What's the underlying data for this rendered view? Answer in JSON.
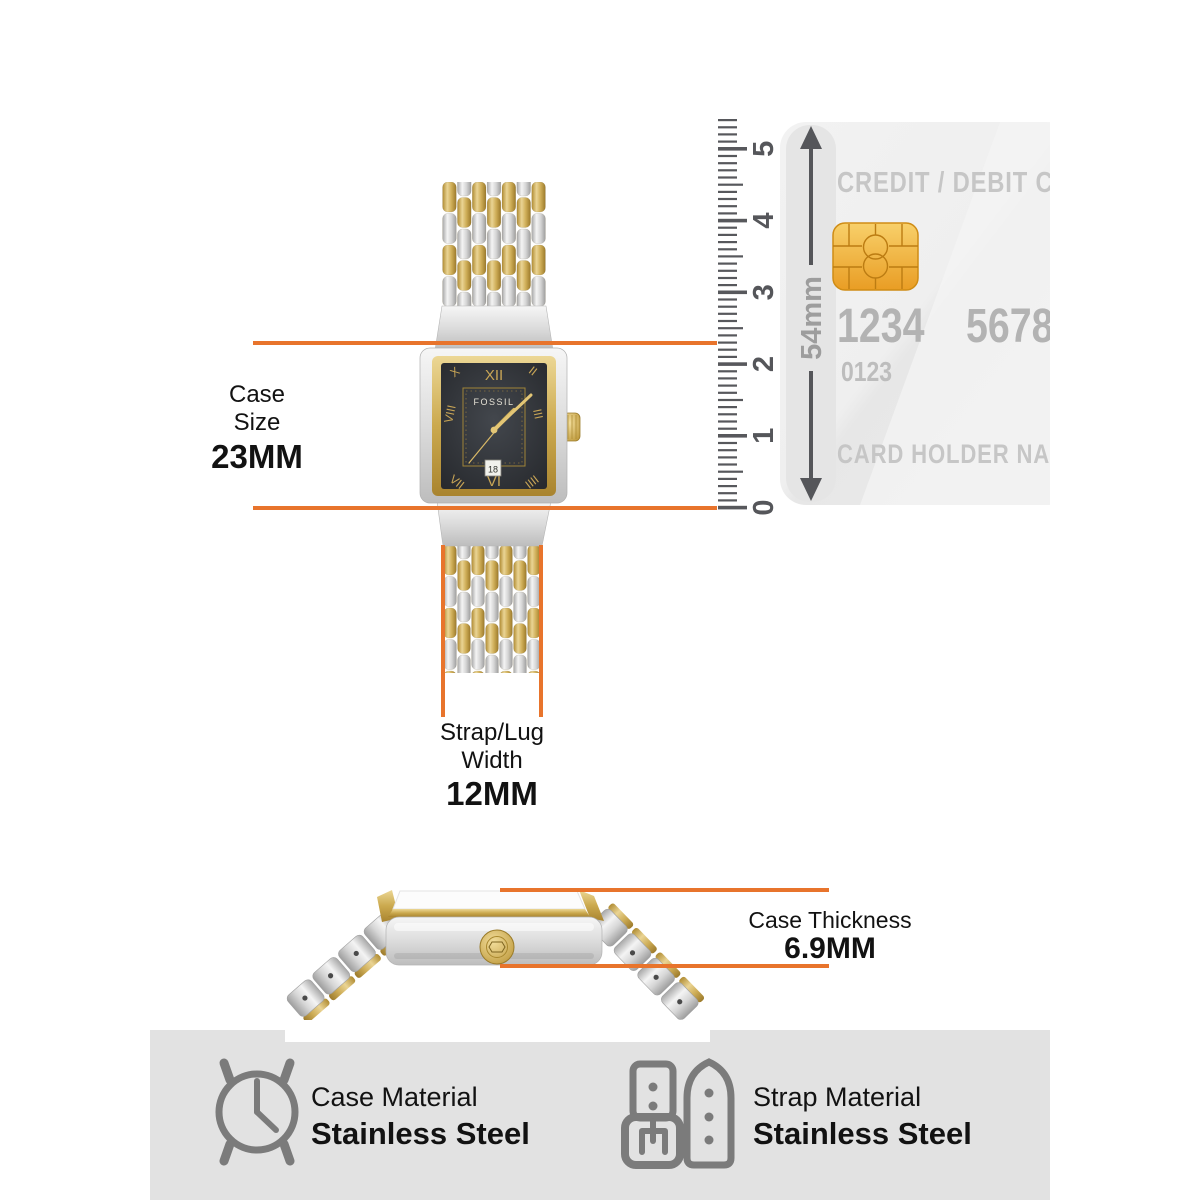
{
  "annotations": {
    "case_size": {
      "label_line1": "Case",
      "label_line2": "Size",
      "value": "23MM"
    },
    "strap_width": {
      "label_line1": "Strap/Lug",
      "label_line2": "Width",
      "value": "12MM"
    },
    "case_thickness": {
      "label": "Case Thickness",
      "value": "6.9MM"
    }
  },
  "ruler": {
    "unit_labels": [
      "0",
      "1",
      "2",
      "3",
      "4",
      "5"
    ],
    "height_label": "54mm"
  },
  "card": {
    "title": "CREDIT / DEBIT CARD",
    "number_left": "1234",
    "number_right": "5678",
    "number_small": "0123",
    "holder": "CARD HOLDER NAME"
  },
  "watch": {
    "brand": "FOSSIL",
    "date": "18",
    "numerals": {
      "top": "XII",
      "bottom": "VI",
      "upper_left": "X",
      "left": "VIII",
      "lower_left": "VII",
      "upper_right": "II",
      "right": "III",
      "lower_right": "IIII"
    }
  },
  "footer": {
    "case_material": {
      "label": "Case Material",
      "value": "Stainless Steel"
    },
    "strap_material": {
      "label": "Strap Material",
      "value": "Stainless Steel"
    }
  },
  "colors": {
    "accent_orange": "#E8742C",
    "gold": "#CFAE58",
    "gold_light": "#EAD494",
    "gold_dark": "#A9842F",
    "silver": "#D9D9D9",
    "silver_light": "#F4F4F4",
    "silver_dark": "#ABABAB",
    "dial": "#2C2F33",
    "ruler_tick": "#57585C",
    "card_bg": "#EDEDED",
    "card_text": "#C4C4C4",
    "chip_gold": "#F2B93F",
    "footer_bg": "#E2E2E2",
    "icon_gray": "#7B7B7B"
  }
}
